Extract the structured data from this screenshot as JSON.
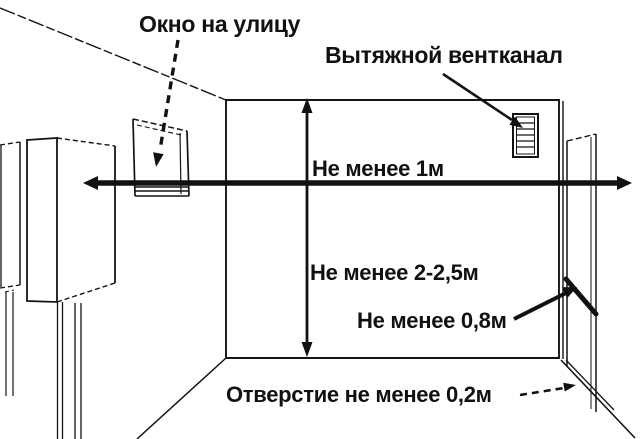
{
  "diagram": {
    "description": "Gas boiler room installation clearances diagram",
    "labels": {
      "window": "Окно на улицу",
      "vent": "Вытяжной вентканал",
      "min_width": "Не менее 1м",
      "min_height": "Не менее 2-2,5м",
      "min_door": "Не менее 0,8м",
      "min_opening": "Отверстие не менее 0,2м"
    },
    "colors": {
      "ink": "#141414",
      "background": "#ffffff"
    }
  }
}
